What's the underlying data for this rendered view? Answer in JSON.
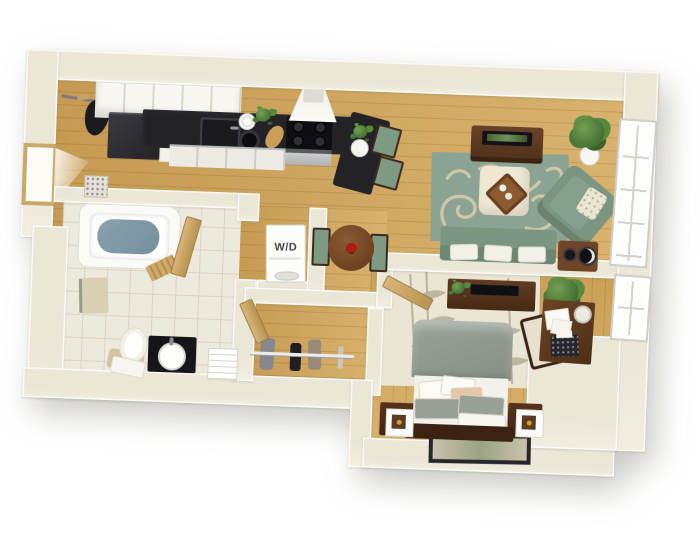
{
  "scene": {
    "type": "3d-floor-plan",
    "labels": {
      "washer_dryer": "W/D"
    },
    "palette": {
      "background": "#ffffff",
      "wall": "#eae7d7",
      "wall_face": "#f6f5ec",
      "wood_floor": "#cda45e",
      "tile_floor": "#eceadd",
      "counter_black": "#232327",
      "cabinet_white": "#f8f7f2",
      "upholstery_green": "#7e9a82",
      "rug_green": "#8ba393",
      "rug_cream": "#ebe5d4",
      "dark_wood": "#53331e",
      "bed_blanket": "#97a096",
      "linen_white": "#f3f1ea",
      "accent_red": "#a32015",
      "plant_green": "#4c7d3a",
      "bath_water": "#7f97a3"
    },
    "rooms": [
      {
        "name": "entry",
        "furniture": [
          "front door",
          "coat rod with coat",
          "door mat"
        ]
      },
      {
        "name": "kitchen",
        "furniture": [
          "upper cabinets",
          "refrigerator",
          "black counter with sink",
          "cooktop",
          "range hood",
          "oven",
          "lower cabinets",
          "breakfast bar with plant vase",
          "2 bar stools"
        ]
      },
      {
        "name": "dining nook",
        "furniture": [
          "round table",
          "2 green chairs",
          "red flower centerpiece"
        ]
      },
      {
        "name": "laundry closet",
        "furniture": [
          "stacked washer dryer"
        ]
      },
      {
        "name": "living room",
        "furniture": [
          "TV console with TV",
          "swirl area rug",
          "ottoman with tray",
          "green armchair with pillow",
          "green sofa with 3 white pillows",
          "radio side table",
          "potted plant",
          "window"
        ]
      },
      {
        "name": "bathroom",
        "furniture": [
          "bathtub",
          "bath step mat",
          "wall towel",
          "toilet with mat",
          "black vanity with round sink",
          "towel shelf",
          "door"
        ]
      },
      {
        "name": "closet",
        "furniture": [
          "hanging rod",
          "4 garments",
          "door"
        ]
      },
      {
        "name": "bedroom",
        "furniture": [
          "double bed",
          "headboard",
          "6 pillows",
          "2 nightstands",
          "2 cube lamps",
          "dresser with TV and plant",
          "potted plant",
          "desk with papers, lamp and typewriter",
          "desk chair",
          "bamboo rug",
          "floor art",
          "window",
          "door"
        ]
      }
    ]
  }
}
